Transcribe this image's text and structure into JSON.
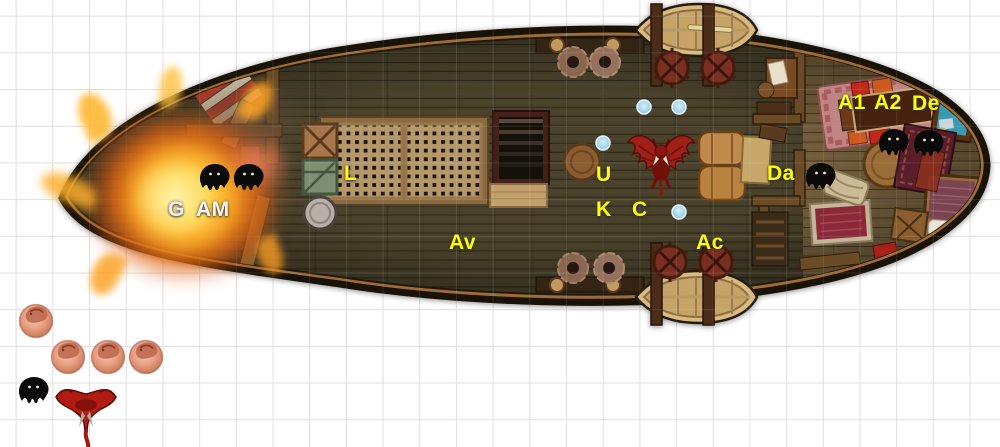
{
  "scene": {
    "kind": "virtual-tabletop ship battle map",
    "background": "#ffffff",
    "grid": {
      "cell_px": 36.7,
      "line_color": "#dcdcdc",
      "offset_px": 15.7
    }
  },
  "palette": {
    "label_yellow": "#ffff00",
    "label_white": "#f4f4f4",
    "deck_wood": "#49412b",
    "cabin_wood": "#6e5836",
    "hull_rim": "#8a5c2c",
    "fire_orange": "#f07818",
    "fire_yellow": "#ffd446",
    "token_black": "#0a0a0a",
    "token_red": "#a82016",
    "token_pink": "#e8a184",
    "marker_blue": "#a8d8ec"
  },
  "labels": [
    {
      "id": "G",
      "text": "G",
      "color": "#f4f4f4",
      "x": 168,
      "y": 199
    },
    {
      "id": "AM",
      "text": "AM",
      "color": "#f4f4f4",
      "x": 196,
      "y": 199
    },
    {
      "id": "L",
      "text": "L",
      "color": "#ffff00",
      "x": 344,
      "y": 163
    },
    {
      "id": "Av",
      "text": "Av",
      "color": "#ffff00",
      "x": 449,
      "y": 232
    },
    {
      "id": "U",
      "text": "U",
      "color": "#ffff00",
      "x": 596,
      "y": 164
    },
    {
      "id": "K",
      "text": "K",
      "color": "#ffff00",
      "x": 596,
      "y": 199
    },
    {
      "id": "C",
      "text": "C",
      "color": "#ffff00",
      "x": 632,
      "y": 199
    },
    {
      "id": "Ac",
      "text": "Ac",
      "color": "#ffff00",
      "x": 696,
      "y": 232
    },
    {
      "id": "Da",
      "text": "Da",
      "color": "#ffff00",
      "x": 767,
      "y": 163
    },
    {
      "id": "A1",
      "text": "A1",
      "color": "#ffff00",
      "x": 838,
      "y": 92
    },
    {
      "id": "A2",
      "text": "A2",
      "color": "#ffff00",
      "x": 874,
      "y": 92
    },
    {
      "id": "De",
      "text": "De",
      "color": "#ffff00",
      "x": 912,
      "y": 93
    }
  ],
  "tokens": {
    "bat_positions": [
      {
        "x": 198,
        "y": 163
      },
      {
        "x": 232,
        "y": 163
      },
      {
        "x": 804,
        "y": 162
      },
      {
        "x": 877,
        "y": 128
      },
      {
        "x": 912,
        "y": 129
      },
      {
        "x": 17,
        "y": 376
      }
    ],
    "pig_positions": [
      {
        "x": 16,
        "y": 300
      },
      {
        "x": 48,
        "y": 336
      },
      {
        "x": 88,
        "y": 336
      },
      {
        "x": 126,
        "y": 336
      }
    ],
    "demon_on_deck": {
      "x": 626,
      "y": 126
    },
    "demon_offship": {
      "x": 50,
      "y": 383
    },
    "blue_markers": [
      {
        "x": 644,
        "y": 107
      },
      {
        "x": 679,
        "y": 107
      },
      {
        "x": 603,
        "y": 143
      },
      {
        "x": 679,
        "y": 212
      }
    ]
  },
  "map_objects": [
    "fire-explosion",
    "cargo-grate",
    "stairs-below-deck",
    "wood-crate",
    "green-crate",
    "barrels",
    "rowboat-top",
    "rowboat-bottom",
    "davit-winches",
    "rope-coils",
    "cabin-table-with-cushions",
    "captain-desk-with-map",
    "bed",
    "rugs",
    "cabin-bulkhead"
  ]
}
